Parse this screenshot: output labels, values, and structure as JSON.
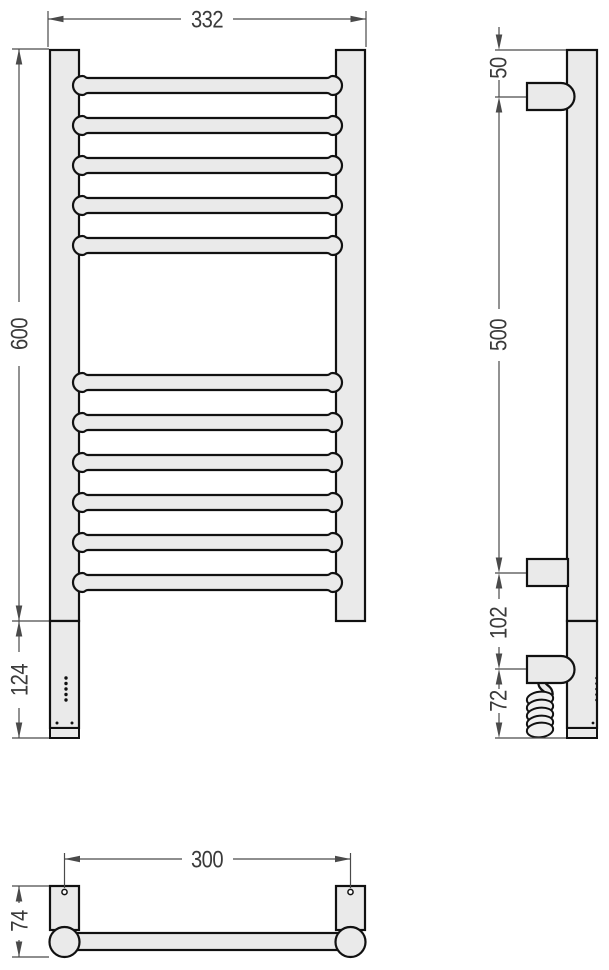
{
  "drawing": {
    "type": "technical-dimension-drawing",
    "subject": "ladder-style heated towel rail, three orthographic views",
    "colors": {
      "paper": "#ffffff",
      "part-fill": "#eaeaea",
      "outline": "#111111",
      "dim-line": "#4a4a4a",
      "dim-text": "#3a3a3a"
    },
    "views": {
      "front": {
        "label": "front-view",
        "rail_count_upper_group": 5,
        "rail_count_lower_group": 6,
        "led_dot_count": 5,
        "button_dot_count": 2,
        "dimensions": {
          "width": "332",
          "height": "600",
          "control_height": "124"
        }
      },
      "side": {
        "label": "side-view",
        "dimensions": {
          "top_to_upper_bracket": "50",
          "bracket_spacing": "500",
          "lower_bracket_to_inlet": "102",
          "inlet_to_bottom": "72"
        }
      },
      "bottom": {
        "label": "bottom-view",
        "dimensions": {
          "mounting_centers": "300",
          "depth": "74"
        }
      }
    }
  }
}
